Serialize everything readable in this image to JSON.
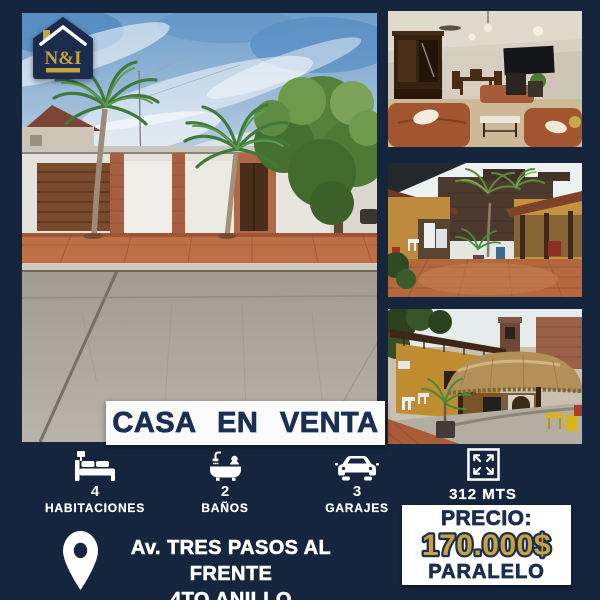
{
  "colors": {
    "background": "#15253E",
    "badge_navy": "#1C2C4F",
    "gold": "#C8A23C",
    "navy_text": "#1B2F52",
    "white": "#FFFFFF"
  },
  "logo": {
    "icon": "house-badge-icon",
    "text": "N&I"
  },
  "banner": {
    "title": "CASA EN VENTA"
  },
  "features": [
    {
      "icon": "bed-icon",
      "value": "4",
      "label": "HABITACIONES"
    },
    {
      "icon": "bathtub-icon",
      "value": "2",
      "label": "BAÑOS"
    },
    {
      "icon": "car-icon",
      "value": "3",
      "label": "GARAJES"
    },
    {
      "icon": "expand-icon",
      "value": "",
      "label": "312 MTS"
    }
  ],
  "address": {
    "icon": "location-pin-icon",
    "line1": "Av. TRES PASOS AL FRENTE",
    "line2": "4TO ANILLO"
  },
  "price": {
    "label": "PRECIO:",
    "amount": "170.000$",
    "note": "PARALELO"
  }
}
